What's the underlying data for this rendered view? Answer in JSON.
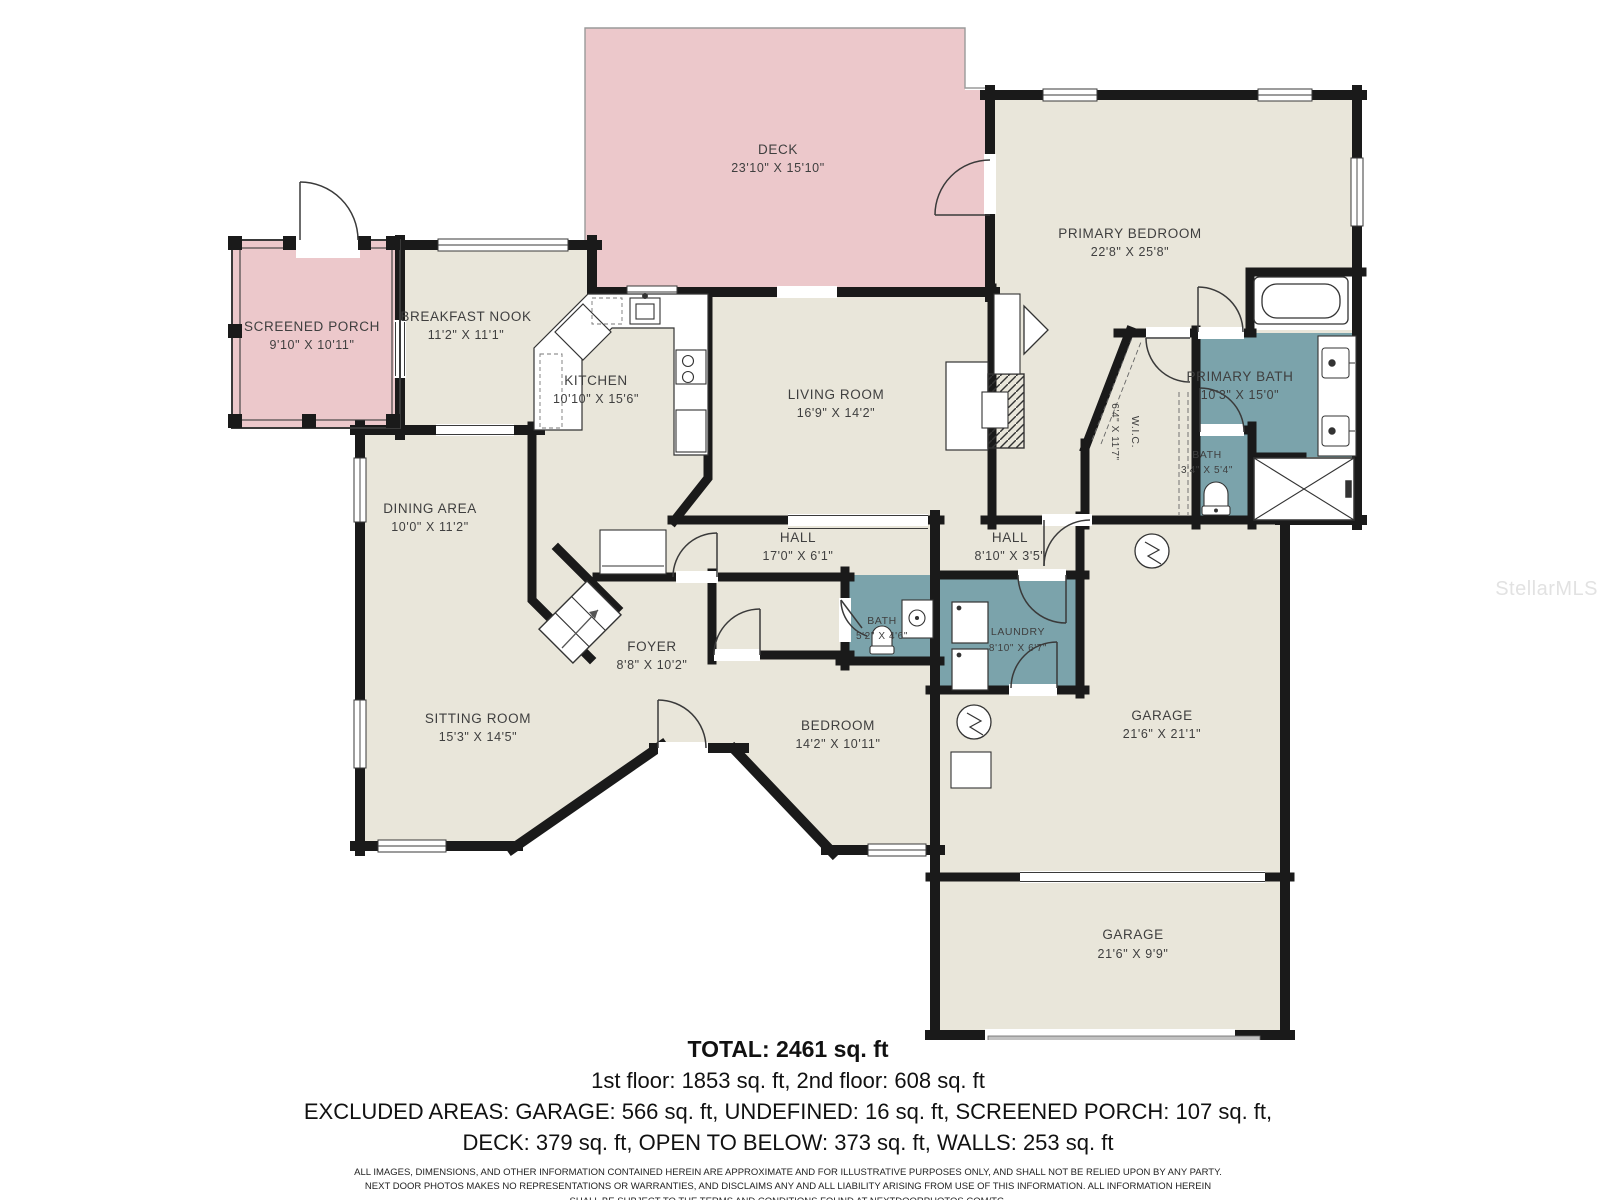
{
  "watermark": "StellarMLS",
  "colors": {
    "room": "#e9e6da",
    "porch": "#ecc8cb",
    "wet": "#7ba3ab",
    "wall": "#1a1a1a"
  },
  "rooms": {
    "deck": {
      "name": "DECK",
      "dims": "23'10\" X 15'10\""
    },
    "screened_porch": {
      "name": "SCREENED PORCH",
      "dims": "9'10\" X 10'11\""
    },
    "breakfast_nook": {
      "name": "BREAKFAST NOOK",
      "dims": "11'2\" X 11'1\""
    },
    "kitchen": {
      "name": "KITCHEN",
      "dims": "10'10\" X 15'6\""
    },
    "living_room": {
      "name": "LIVING ROOM",
      "dims": "16'9\" X 14'2\""
    },
    "primary_bedroom": {
      "name": "PRIMARY BEDROOM",
      "dims": "22'8\" X 25'8\""
    },
    "primary_bath": {
      "name": "PRIMARY BATH",
      "dims": "10'3\" X 15'0\""
    },
    "wic": {
      "name": "W.I.C.",
      "dims": "6'4\" X 11'7\""
    },
    "bath_upper": {
      "name": "BATH",
      "dims": "3'4\" X 5'4\""
    },
    "dining_area": {
      "name": "DINING AREA",
      "dims": "10'0\" X 11'2\""
    },
    "hall_main": {
      "name": "HALL",
      "dims": "17'0\" X 6'1\""
    },
    "hall_small": {
      "name": "HALL",
      "dims": "8'10\" X 3'5\""
    },
    "foyer": {
      "name": "FOYER",
      "dims": "8'8\" X 10'2\""
    },
    "bath_hall": {
      "name": "BATH",
      "dims": "5'2\" X 4'6\""
    },
    "laundry": {
      "name": "LAUNDRY",
      "dims": "8'10\" X 6'7\""
    },
    "sitting_room": {
      "name": "SITTING ROOM",
      "dims": "15'3\" X 14'5\""
    },
    "bedroom": {
      "name": "BEDROOM",
      "dims": "14'2\" X 10'11\""
    },
    "garage_main": {
      "name": "GARAGE",
      "dims": "21'6\" X 21'1\""
    },
    "garage_lower": {
      "name": "GARAGE",
      "dims": "21'6\" X 9'9\""
    }
  },
  "footer": {
    "total": "TOTAL: 2461 sq. ft",
    "floors": "1st floor: 1853 sq. ft, 2nd floor: 608 sq. ft",
    "excluded_line1": "EXCLUDED AREAS: GARAGE: 566 sq. ft, UNDEFINED: 16 sq. ft, SCREENED PORCH: 107 sq. ft,",
    "excluded_line2": "DECK: 379 sq. ft, OPEN TO BELOW: 373 sq. ft, WALLS: 253 sq. ft",
    "disclaimer_line1": "ALL IMAGES, DIMENSIONS, AND OTHER INFORMATION CONTAINED HEREIN ARE APPROXIMATE AND FOR ILLUSTRATIVE PURPOSES ONLY, AND SHALL NOT BE RELIED UPON BY ANY PARTY.",
    "disclaimer_line2": "NEXT DOOR PHOTOS MAKES NO REPRESENTATIONS OR WARRANTIES, AND DISCLAIMS ANY AND ALL LIABILITY ARISING FROM USE OF THIS INFORMATION. ALL INFORMATION HEREIN",
    "disclaimer_line3": "SHALL BE SUBJECT TO THE TERMS AND CONDITIONS FOUND AT NEXTDOORPHOTOS.COM/TC."
  }
}
